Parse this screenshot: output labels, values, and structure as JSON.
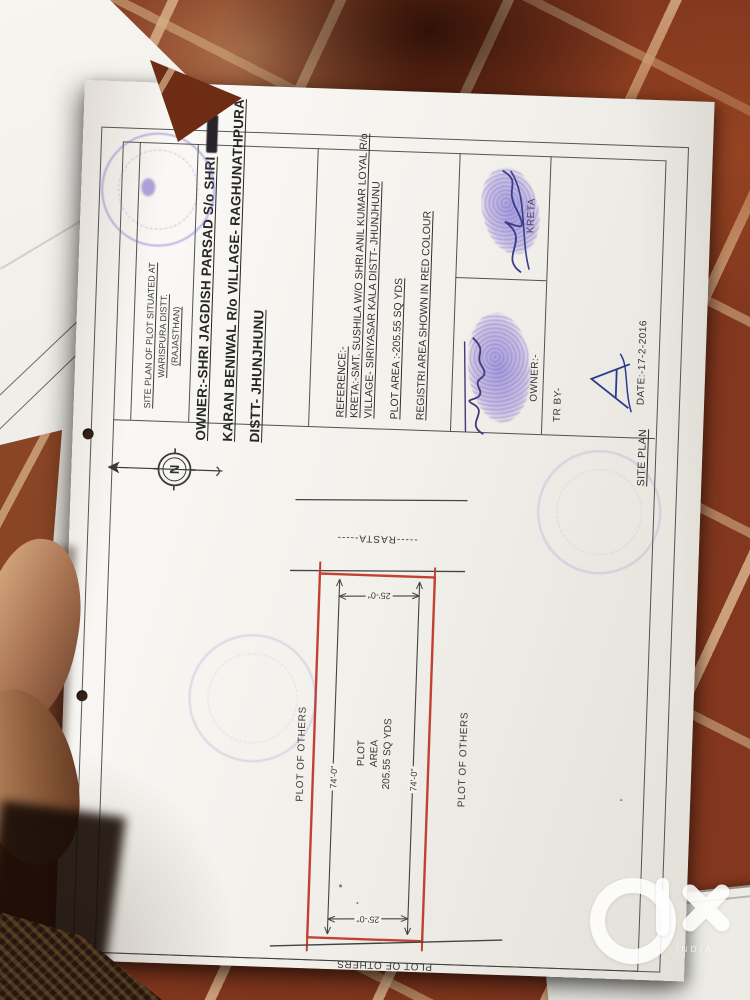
{
  "watermark": {
    "brand": "OLX",
    "country": "INDIA"
  },
  "sheet": {
    "title_block": {
      "lines": [
        "SITE PLAN OF PLOT SITUATED AT",
        "WARISPURA DISTT.",
        "(RAJASTHAN)"
      ]
    },
    "owner_block": {
      "line1": "OWNER:-SHRI JAGDISH PARSAD S/o SHRI",
      "line2": "KARAN BENIWAL R/o VILLAGE- RAGHUNATHPURA",
      "line3": "DISTT- JHUNJHUNU"
    },
    "reference_block": {
      "heading": "REFERENCE:-",
      "kreta_line1": "KRETA:-SMT. SUSHILA W/O SHRI ANIL KUMAR LOYAL R/o",
      "kreta_line2": "VILLAGE- SIRIYASAR KALA DISTT- JHUNJHUNU",
      "plot_area": "PLOT AREA :-205.55 SQ YDS",
      "note": "REGISTRI AREA SHOWN IN RED COLOUR"
    },
    "signatures": {
      "kreta_label": "KRETA",
      "owner_label": "OWNER:-",
      "tr_by_label": "TR BY-",
      "date": "DATE:-17-2-2016"
    },
    "drawing": {
      "section_label": "SITE PLAN",
      "road_label": "-----RASTA-----",
      "width_dim": "25'-0\"",
      "length_dim": "74'-0\"",
      "area_lines": [
        "PLOT",
        "AREA",
        "205.55 SQ YDS"
      ],
      "neighbor_label": "PLOT OF OTHERS",
      "compass_letter": "N"
    },
    "colors": {
      "plot_outline": "#c0392b",
      "stamp_ink": "#7b6ec9",
      "signature_ink": "#2b3a8c"
    }
  }
}
